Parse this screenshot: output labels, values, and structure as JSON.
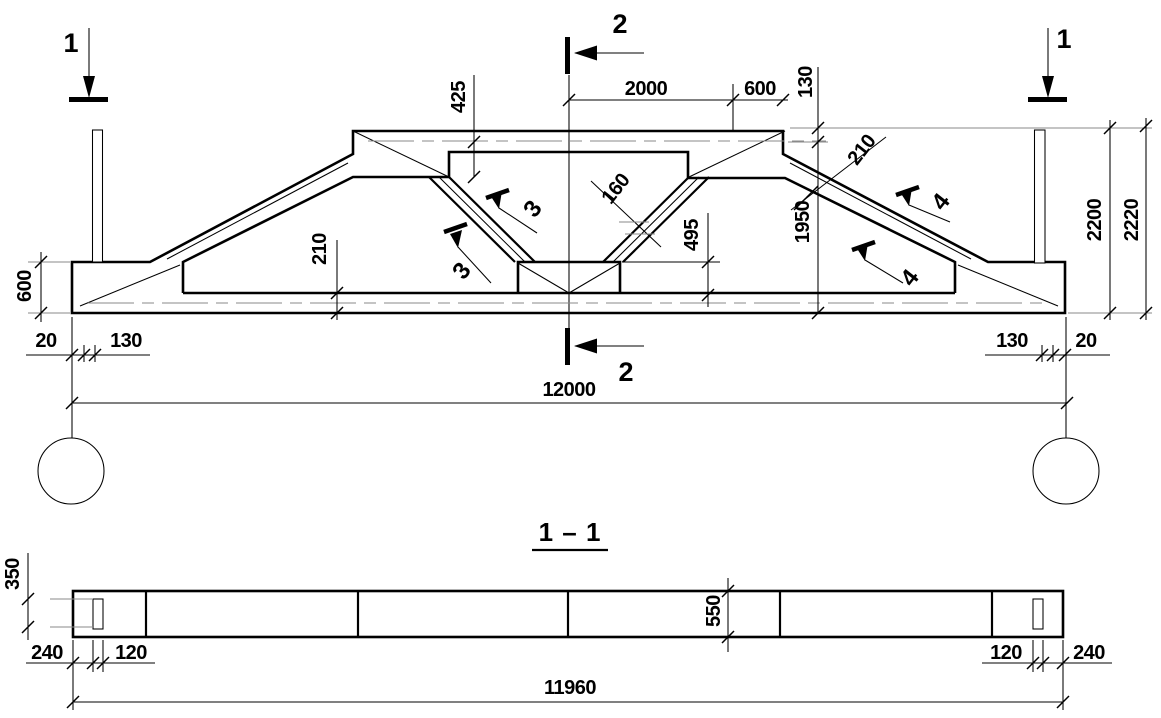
{
  "drawing_type": "precast-concrete-lattice-girder-shop-drawing",
  "colors": {
    "line": "#000000",
    "centerline_gray": "#8a8a8a",
    "background": "#ffffff"
  },
  "elevation": {
    "markers": {
      "left": "1",
      "right": "1",
      "top": "2",
      "bottom": "2"
    },
    "flags": {
      "upper_left": "3",
      "lower_left": "3",
      "upper_right": "4",
      "lower_right": "4"
    },
    "dims": {
      "d425": "425",
      "d2000": "2000",
      "d600_top": "600",
      "d130_top": "130",
      "d210_haunch": "210",
      "d160": "160",
      "d1950": "1950",
      "d495": "495",
      "d2200": "2200",
      "d2220": "2220",
      "d210_chord": "210",
      "d600_left": "600",
      "d20_left": "20",
      "d130_left": "130",
      "d130_right": "130",
      "d20_right": "20",
      "d12000": "12000"
    }
  },
  "section": {
    "title": "1 – 1",
    "dims": {
      "d350": "350",
      "d550": "550",
      "d240_left": "240",
      "d120_left": "120",
      "d120_right": "120",
      "d240_right": "240",
      "d11960": "11960"
    }
  }
}
